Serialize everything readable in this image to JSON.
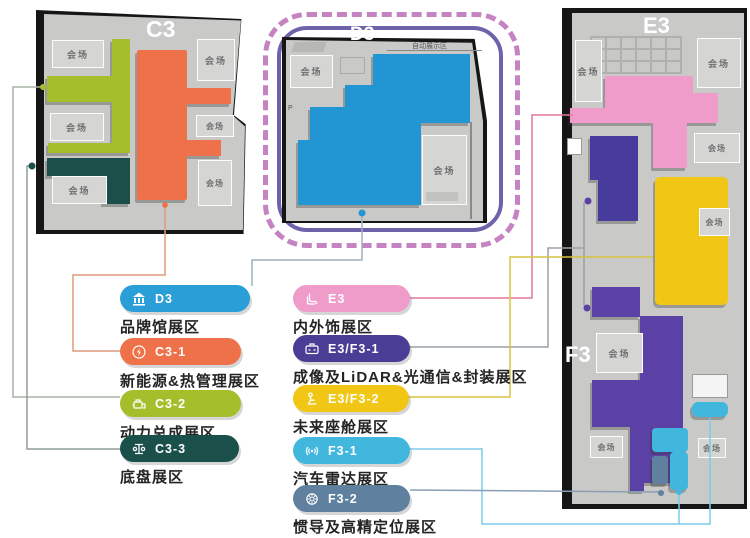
{
  "palette": {
    "hall": "#c9c9c8",
    "boxFill": "#d5d5d4",
    "boxText": "#6f6f6f",
    "dashPink": "#c583c2",
    "ringPurple": "#6f62ab",
    "blue": "#2196d2",
    "orange": "#ef7149",
    "green": "#a4bf2b",
    "teal": "#1b4f4a",
    "pink": "#f09cca",
    "indigo": "#473c9b",
    "violet": "#5b41a5",
    "yellow": "#f2c614",
    "cyan": "#41b7de",
    "slate": "#5f819f"
  },
  "venue_label": "会场",
  "halls": {
    "c3": {
      "title": "C3"
    },
    "d3": {
      "title": "D3",
      "demo_label": "自动展示区",
      "parking_label": "P"
    },
    "e3": {
      "title": "E3",
      "f3_title": "F3"
    }
  },
  "legend": {
    "left": [
      {
        "code": "D3",
        "label": "品牌馆展区",
        "color": "#2a9ed6",
        "icon": "museum-icon"
      },
      {
        "code": "C3-1",
        "label": "新能源&热管理展区",
        "color": "#ef7149",
        "icon": "energy-icon"
      },
      {
        "code": "C3-2",
        "label": "动力总成展区",
        "color": "#a4bf2b",
        "icon": "powertrain-icon"
      },
      {
        "code": "C3-3",
        "label": "底盘展区",
        "color": "#1b4f4a",
        "icon": "chassis-icon"
      }
    ],
    "right": [
      {
        "code": "E3",
        "label": "内外饰展区",
        "color": "#f09cca",
        "icon": "interior-trim-icon"
      },
      {
        "code": "E3/F3-1",
        "label": "成像及LiDAR&光通信&封装展区",
        "color": "#4a3d96",
        "icon": "imaging-icon"
      },
      {
        "code": "E3/F3-2",
        "label": "未来座舱展区",
        "color": "#f2c614",
        "icon": "cockpit-icon"
      },
      {
        "code": "F3-1",
        "label": "汽车雷达展区",
        "color": "#41b7de",
        "icon": "radar-icon"
      },
      {
        "code": "F3-2",
        "label": "惯导及高精定位展区",
        "color": "#5f819f",
        "icon": "navigation-icon"
      }
    ]
  }
}
